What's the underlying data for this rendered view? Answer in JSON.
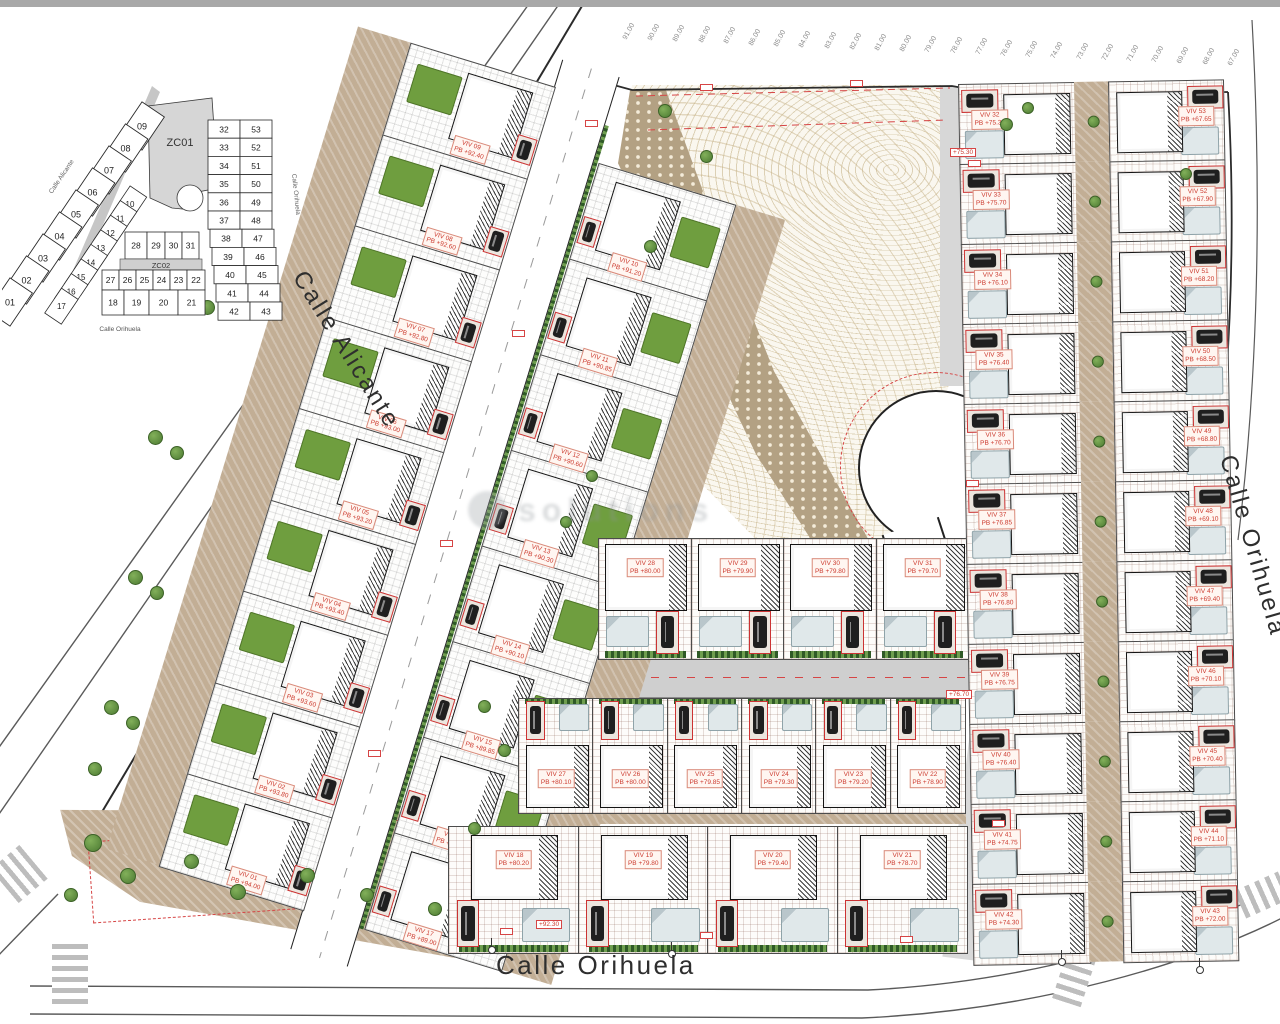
{
  "window": {
    "top_bar_color": "#a8a8a8"
  },
  "streets": {
    "alicante": "Calle Alicante",
    "orihuela_bottom": "Calle Orihuela",
    "orihuela_right": "Calle Orihuela"
  },
  "watermark": {
    "text": "solutions"
  },
  "key_plan": {
    "zone_labels": [
      "ZC01",
      "ZC02"
    ],
    "streets": {
      "alicante": "Calle Alicante",
      "orihuela_bottom": "Calle Orihuela",
      "orihuela_right": "Calle Orihuela"
    },
    "outer_strip": [
      "09",
      "08",
      "07",
      "06",
      "05",
      "04",
      "03",
      "02",
      "01"
    ],
    "inner_strip": [
      "10",
      "11",
      "12",
      "13",
      "14",
      "15",
      "16",
      "17"
    ],
    "row_top": [
      "28",
      "29",
      "30",
      "31"
    ],
    "row_mid": [
      "27",
      "26",
      "25",
      "24",
      "23",
      "22"
    ],
    "row_bottom": [
      "18",
      "19",
      "20",
      "21"
    ],
    "right_pairs": [
      [
        "32",
        "53"
      ],
      [
        "33",
        "52"
      ],
      [
        "34",
        "51"
      ],
      [
        "35",
        "50"
      ],
      [
        "36",
        "49"
      ],
      [
        "37",
        "48"
      ],
      [
        "38",
        "47"
      ],
      [
        "39",
        "46"
      ],
      [
        "40",
        "45"
      ],
      [
        "41",
        "44"
      ],
      [
        "42",
        "43"
      ]
    ]
  },
  "elevation_labels": [
    "91.00",
    "90.00",
    "89.00",
    "88.00",
    "87.00",
    "86.00",
    "85.00",
    "84.00",
    "83.00",
    "82.00",
    "81.00",
    "80.00",
    "79.00",
    "78.00",
    "77.00",
    "76.00",
    "75.00",
    "74.00",
    "73.00",
    "72.00",
    "71.00",
    "70.00",
    "69.00",
    "68.00",
    "67.00"
  ],
  "road_marks": [
    {
      "text": "+75.30"
    },
    {
      "text": "+76.70"
    },
    {
      "text": "+92.30"
    }
  ],
  "villas": {
    "left_outer": [
      {
        "id": "VIV 09",
        "pb": "PB +92.40"
      },
      {
        "id": "VIV 08",
        "pb": "PB +92.60"
      },
      {
        "id": "VIV 07",
        "pb": "PB +92.80"
      },
      {
        "id": "VIV 06",
        "pb": "PB +93.00"
      },
      {
        "id": "VIV 05",
        "pb": "PB +93.20"
      },
      {
        "id": "VIV 04",
        "pb": "PB +93.40"
      },
      {
        "id": "VIV 03",
        "pb": "PB +93.60"
      },
      {
        "id": "VIV 02",
        "pb": "PB +93.80"
      },
      {
        "id": "VIV 01",
        "pb": "PB +94.00"
      }
    ],
    "left_inner": [
      {
        "id": "VIV 10",
        "pb": "PB +91.20"
      },
      {
        "id": "VIV 11",
        "pb": "PB +90.85"
      },
      {
        "id": "VIV 12",
        "pb": "PB +90.60"
      },
      {
        "id": "VIV 13",
        "pb": "PB +90.30"
      },
      {
        "id": "VIV 14",
        "pb": "PB +90.10"
      },
      {
        "id": "VIV 15",
        "pb": "PB +89.85"
      },
      {
        "id": "VIV 16",
        "pb": "PB +89.60"
      },
      {
        "id": "VIV 17",
        "pb": "PB +89.00"
      }
    ],
    "row_top": [
      {
        "id": "VIV 28",
        "pb": "PB +80.00"
      },
      {
        "id": "VIV 29",
        "pb": "PB +79.90"
      },
      {
        "id": "VIV 30",
        "pb": "PB +79.80"
      },
      {
        "id": "VIV 31",
        "pb": "PB +79.70"
      }
    ],
    "row_mid": [
      {
        "id": "VIV 27",
        "pb": "PB +80.10"
      },
      {
        "id": "VIV 26",
        "pb": "PB +80.00"
      },
      {
        "id": "VIV 25",
        "pb": "PB +79.85"
      },
      {
        "id": "VIV 24",
        "pb": "PB +79.30"
      },
      {
        "id": "VIV 23",
        "pb": "PB +79.20"
      },
      {
        "id": "VIV 22",
        "pb": "PB +78.90"
      }
    ],
    "row_bottom": [
      {
        "id": "VIV 18",
        "pb": "PB +80.20"
      },
      {
        "id": "VIV 19",
        "pb": "PB +79.80"
      },
      {
        "id": "VIV 20",
        "pb": "PB +79.40"
      },
      {
        "id": "VIV 21",
        "pb": "PB +78.70"
      }
    ],
    "right_left": [
      {
        "id": "VIV 32",
        "pb": "PB +75.30"
      },
      {
        "id": "VIV 33",
        "pb": "PB +75.70"
      },
      {
        "id": "VIV 34",
        "pb": "PB +76.10"
      },
      {
        "id": "VIV 35",
        "pb": "PB +76.40"
      },
      {
        "id": "VIV 36",
        "pb": "PB +76.70"
      },
      {
        "id": "VIV 37",
        "pb": "PB +76.85"
      },
      {
        "id": "VIV 38",
        "pb": "PB +76.80"
      },
      {
        "id": "VIV 39",
        "pb": "PB +76.75"
      },
      {
        "id": "VIV 40",
        "pb": "PB +76.40"
      },
      {
        "id": "VIV 41",
        "pb": "PB +74.75"
      },
      {
        "id": "VIV 42",
        "pb": "PB +74.30"
      }
    ],
    "right_right": [
      {
        "id": "VIV 53",
        "pb": "PB +67.65"
      },
      {
        "id": "VIV 52",
        "pb": "PB +67.90"
      },
      {
        "id": "VIV 51",
        "pb": "PB +68.20"
      },
      {
        "id": "VIV 50",
        "pb": "PB +68.50"
      },
      {
        "id": "VIV 49",
        "pb": "PB +68.80"
      },
      {
        "id": "VIV 48",
        "pb": "PB +69.10"
      },
      {
        "id": "VIV 47",
        "pb": "PB +69.40"
      },
      {
        "id": "VIV 46",
        "pb": "PB +70.10"
      },
      {
        "id": "VIV 45",
        "pb": "PB +70.40"
      },
      {
        "id": "VIV 44",
        "pb": "PB +71.10"
      },
      {
        "id": "VIV 43",
        "pb": "PB +72.00"
      }
    ]
  },
  "colors": {
    "label_red": "#cc3b2f",
    "pool_green": "#6f9e3f",
    "terrain": "#efe7d2",
    "zone_gray": "#d6d6d6",
    "road_gray": "#cfcfcf"
  }
}
